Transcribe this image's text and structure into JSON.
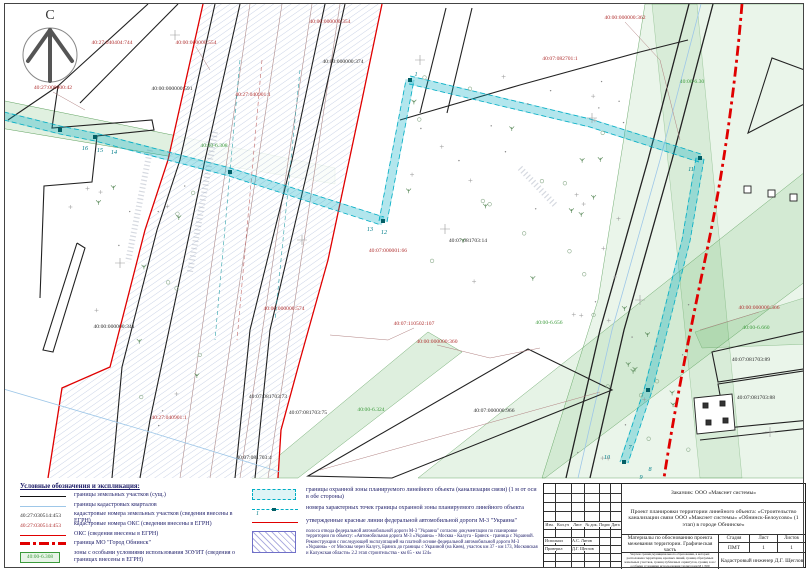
{
  "north_label": "С",
  "legend": {
    "title": "Условные обозначения и экспликация:",
    "left": [
      {
        "label": "границы земельных участков (сущ.)"
      },
      {
        "label": "границы кадастровых кварталов"
      },
      {
        "num": "40:27:030514:453",
        "label": "кадастровые номера земельных участков (сведения внесены в ЕГРН)"
      },
      {
        "num": "40:27:030514:453",
        "label": "кадастровые номера ОКС (сведения внесены в ЕГРН)"
      },
      {
        "label": "ОКС (сведения внесены в ЕГРН)"
      },
      {
        "label": "граница МО \"Город Обнинск\""
      },
      {
        "box": "40:00-6.308",
        "label": "зоны с особыми условиями использования ЗОУИТ (сведения о границах внесены в ЕГРН)"
      }
    ],
    "right": [
      {
        "label": "границы охранной зоны планируемого линейного объекта (канализация связи) (1 м от оси в обе стороны)"
      },
      {
        "num": "1",
        "label": "номера характерных точек границы охранной зоны планируемого линейного объекта"
      },
      {
        "label": "утвержденные красные линии федеральной автомобильной дороги М-3 \"Украина\""
      },
      {
        "label": "полоса отвода федеральной автомобильной дороги М-3 \"Украина\" согласно документации по планировке территории по объекту: «Автомобильная дорога М-3 «Украина» - Москва - Калуга - Брянск - граница с Украиной. Реконструкция с последующей эксплуатацией на платной основе федеральной автомобильной дороги М-3 «Украина» - от Москвы через Калугу, Брянск до границы с Украиной (на Киев), участок км 37 - км 173, Московская и Калужская области» 2.2 этап строительства - км 65 - км 124»"
      }
    ]
  },
  "title_block": {
    "customer": "Заказчик: ООО «Макснет системы»",
    "project": "Проект планировки территории линейного объекта: «Строительство канализации связи ООО «Макснет системы» «Обнинск-Белоусово» (1 этап) в городе Обнинске»",
    "doc_title": "Материалы по обоснованию проекта межевания территории. Графическая часть",
    "header_cols": [
      "Изм.",
      "Кол.уч",
      "Лист",
      "№ док.",
      "Подпись",
      "Дата"
    ],
    "role_rows": [
      {
        "role": "Исполнил",
        "name": "А.С. Литов"
      },
      {
        "role": "Проверил",
        "name": "Д.Г. Щеглов"
      }
    ],
    "stage_h": "Стадия",
    "sheet_h": "Лист",
    "sheets_h": "Листов",
    "stage": "ПМТ",
    "sheet": "1",
    "sheets": "1",
    "note": "Чертеж границ муниципального образования, в которых расположена территория, красных линий, границ образуемых земельных участков, границ публичных сервитутов, границ зон с особыми условиями использования территории М 1:500",
    "engineer": "Кадастровый инженер Д.Г. Щеглов"
  },
  "map": {
    "labels": [
      {
        "t": "40:27:000000:42",
        "x": 53,
        "y": 89,
        "c": "red"
      },
      {
        "t": "40:27:040404:744",
        "x": 112,
        "y": 44,
        "c": "red"
      },
      {
        "t": "40:00:000000:554",
        "x": 196,
        "y": 44,
        "c": "red"
      },
      {
        "t": "40:00:000000:354",
        "x": 330,
        "y": 23,
        "c": "red"
      },
      {
        "t": "40:00:000000:591",
        "x": 172,
        "y": 90,
        "c": "black"
      },
      {
        "t": "40:27:040901:1",
        "x": 253,
        "y": 96,
        "c": "red"
      },
      {
        "t": "40:00:000000:374",
        "x": 343,
        "y": 63,
        "c": "black"
      },
      {
        "t": "40:00:000000:362",
        "x": 625,
        "y": 19,
        "c": "red"
      },
      {
        "t": "40:07:082701:1",
        "x": 560,
        "y": 60,
        "c": "red"
      },
      {
        "t": "40:00-6.308",
        "x": 214,
        "y": 147,
        "c": "green"
      },
      {
        "t": "40:00-6.30",
        "x": 692,
        "y": 83,
        "c": "green"
      },
      {
        "t": "40:07:081703:14",
        "x": 468,
        "y": 242,
        "c": "black"
      },
      {
        "t": "40:07:110502:107",
        "x": 414,
        "y": 325,
        "c": "red"
      },
      {
        "t": "40:00:000000:360",
        "x": 437,
        "y": 343,
        "c": "red"
      },
      {
        "t": "40:00-6.656",
        "x": 549,
        "y": 324,
        "c": "green"
      },
      {
        "t": "40:07:000000:966",
        "x": 494,
        "y": 412,
        "c": "black"
      },
      {
        "t": "40:00:000000:341",
        "x": 114,
        "y": 328,
        "c": "black"
      },
      {
        "t": "40:00:000000:574",
        "x": 284,
        "y": 310,
        "c": "red"
      },
      {
        "t": "40:27:040901:1",
        "x": 169,
        "y": 419,
        "c": "red"
      },
      {
        "t": "40:07:081703:73",
        "x": 268,
        "y": 398,
        "c": "black"
      },
      {
        "t": "40:07:081703:75",
        "x": 308,
        "y": 414,
        "c": "black"
      },
      {
        "t": "40:00-6.324",
        "x": 371,
        "y": 411,
        "c": "green"
      },
      {
        "t": "40:07:081703:4",
        "x": 254,
        "y": 459,
        "c": "black"
      },
      {
        "t": "40:07:000001:66",
        "x": 388,
        "y": 252,
        "c": "red"
      },
      {
        "t": "40:00:000000:366",
        "x": 759,
        "y": 309,
        "c": "red"
      },
      {
        "t": "40:00-6.660",
        "x": 756,
        "y": 329,
        "c": "green"
      },
      {
        "t": "40:07:081703:89",
        "x": 751,
        "y": 361,
        "c": "black"
      },
      {
        "t": "40:07:081703:88",
        "x": 756,
        "y": 399,
        "c": "black"
      }
    ],
    "points": [
      {
        "n": "16",
        "x": 85,
        "y": 150
      },
      {
        "n": "15",
        "x": 100,
        "y": 152
      },
      {
        "n": "14",
        "x": 114,
        "y": 154
      },
      {
        "n": "13",
        "x": 370,
        "y": 231
      },
      {
        "n": "12",
        "x": 384,
        "y": 234
      },
      {
        "n": "1",
        "x": 416,
        "y": 76
      },
      {
        "n": "11",
        "x": 691,
        "y": 171
      },
      {
        "n": "10",
        "x": 607,
        "y": 459
      },
      {
        "n": "7",
        "x": 630,
        "y": 449
      },
      {
        "n": "8",
        "x": 650,
        "y": 471
      },
      {
        "n": "9",
        "x": 641,
        "y": 479
      }
    ]
  }
}
